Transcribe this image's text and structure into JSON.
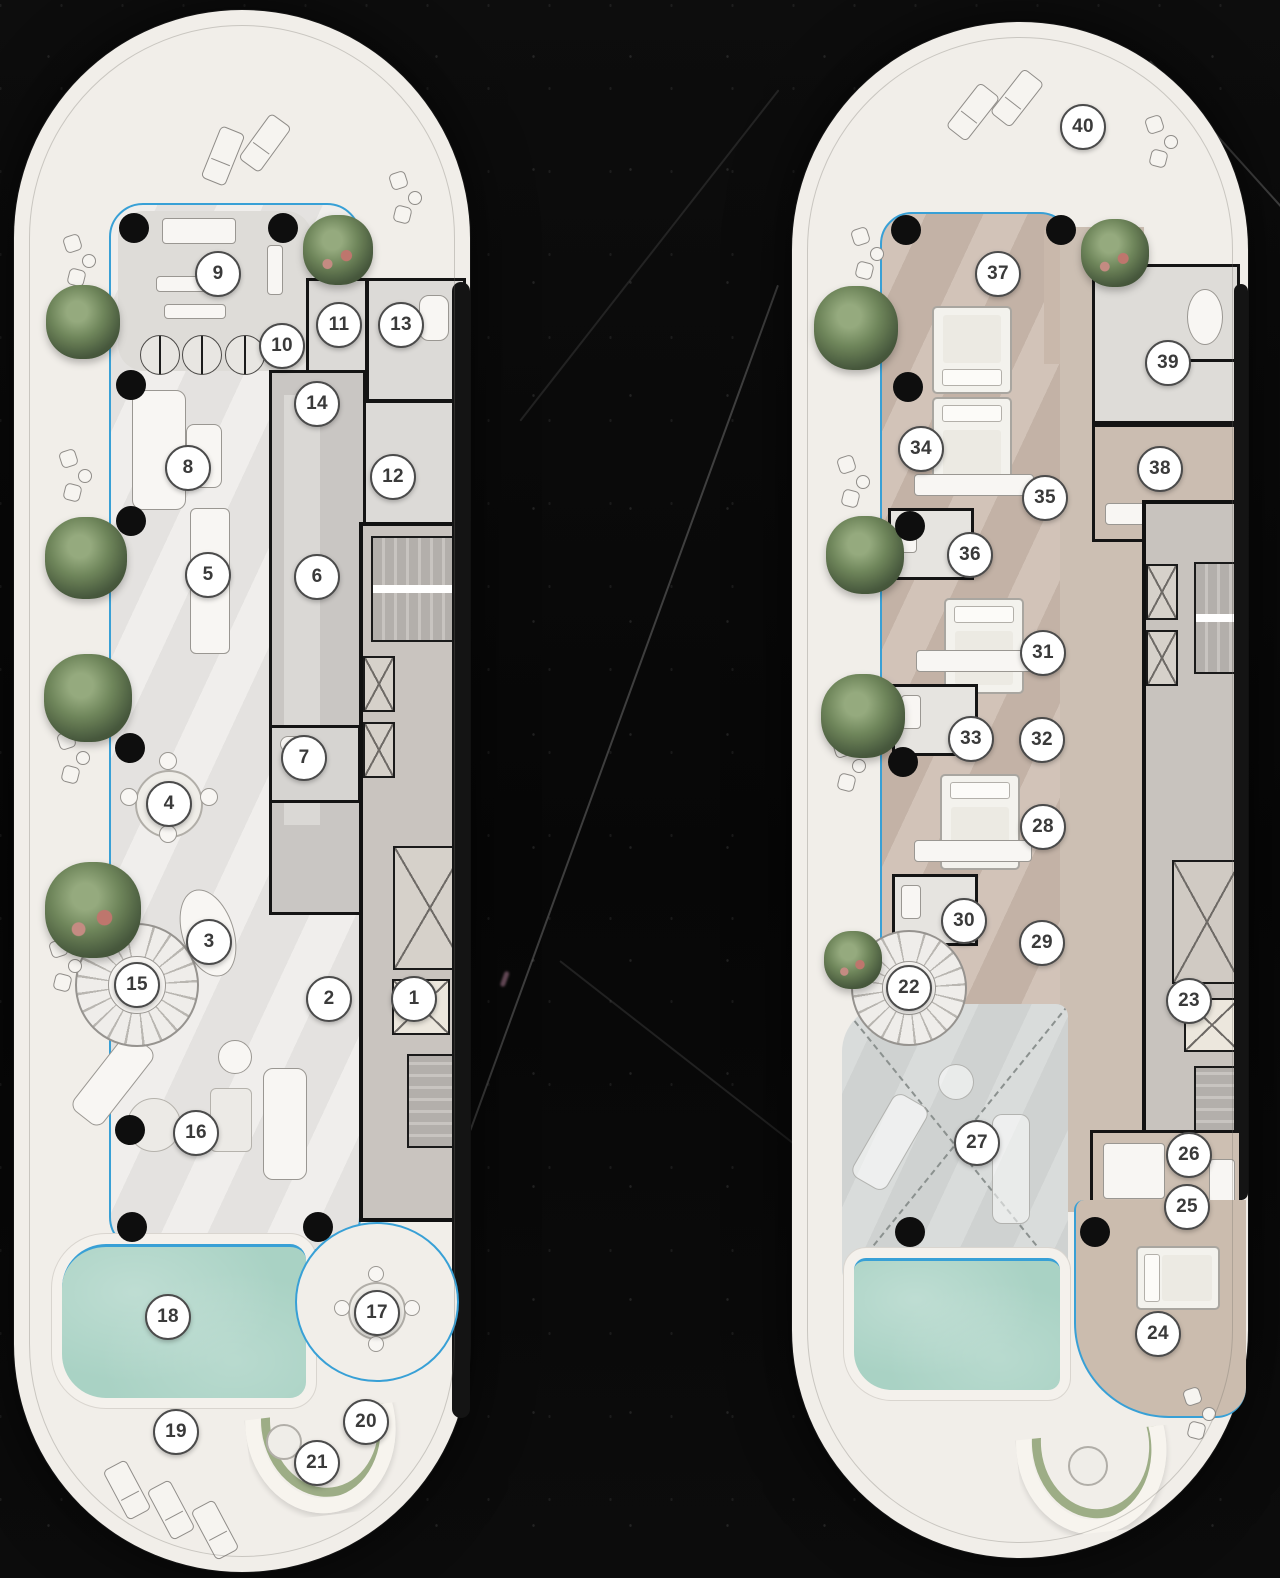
{
  "scene": {
    "description": "Two pill-shaped penthouse floor plans rendered on black marble",
    "palette": {
      "background": "#0a0a0a",
      "marble_vein": "#ffffff",
      "deck_white": "#f1eee9",
      "interior_light_gray": "#e9e7e4",
      "interior_tan": "#c9b8ab",
      "core_gray": "#c9c4bf",
      "stairs_gray": "#b3afab",
      "media_room_gray": "#d3d6d5",
      "pool_teal": "#a9d2c4",
      "facade_blue": "#38a0d6",
      "wall_black": "#141414",
      "plant_green": "#6c8656",
      "marker_bg": "#ffffff",
      "marker_border": "#4b4b4b",
      "marker_text": "#3a3a3a"
    }
  },
  "plans": [
    {
      "dom": "plan-a",
      "markers": [
        [
          1,
          400,
          989
        ],
        [
          2,
          315,
          989
        ],
        [
          3,
          195,
          932
        ],
        [
          4,
          155,
          794
        ],
        [
          5,
          194,
          565
        ],
        [
          6,
          303,
          567
        ],
        [
          7,
          290,
          748
        ],
        [
          8,
          174,
          458
        ],
        [
          9,
          204,
          264
        ],
        [
          10,
          268,
          336
        ],
        [
          11,
          325,
          315
        ],
        [
          12,
          379,
          467
        ],
        [
          13,
          387,
          315
        ],
        [
          14,
          303,
          394
        ],
        [
          15,
          123,
          975
        ],
        [
          16,
          182,
          1123
        ],
        [
          17,
          363,
          1303
        ],
        [
          18,
          154,
          1307
        ],
        [
          19,
          162,
          1422
        ],
        [
          20,
          352,
          1412
        ],
        [
          21,
          303,
          1453
        ]
      ],
      "columns": [
        [
          120,
          218
        ],
        [
          269,
          218
        ],
        [
          117,
          375
        ],
        [
          117,
          511
        ],
        [
          116,
          738
        ],
        [
          116,
          1120
        ],
        [
          118,
          1217
        ],
        [
          304,
          1217
        ]
      ],
      "plants": [
        [
          69,
          312,
          74,
          0
        ],
        [
          72,
          548,
          82,
          0
        ],
        [
          74,
          688,
          88,
          0
        ],
        [
          79,
          900,
          96,
          1
        ],
        [
          324,
          240,
          70,
          1
        ]
      ],
      "loungers": [
        [
          196,
          118,
          22
        ],
        [
          238,
          105,
          36
        ],
        [
          100,
          1452,
          -28
        ],
        [
          144,
          1472,
          -28
        ],
        [
          188,
          1492,
          -28
        ]
      ],
      "chair_pairs": [
        [
          48,
          225
        ],
        [
          44,
          440
        ],
        [
          42,
          722
        ],
        [
          34,
          930
        ],
        [
          374,
          162
        ]
      ]
    },
    {
      "dom": "plan-b",
      "markers": [
        [
          22,
          117,
          966
        ],
        [
          23,
          397,
          979
        ],
        [
          24,
          366,
          1312
        ],
        [
          25,
          395,
          1185
        ],
        [
          26,
          397,
          1133
        ],
        [
          27,
          185,
          1121
        ],
        [
          28,
          251,
          805
        ],
        [
          29,
          250,
          921
        ],
        [
          30,
          172,
          899
        ],
        [
          31,
          251,
          631
        ],
        [
          32,
          250,
          718
        ],
        [
          33,
          179,
          717
        ],
        [
          34,
          129,
          427
        ],
        [
          35,
          253,
          476
        ],
        [
          36,
          178,
          533
        ],
        [
          37,
          206,
          252
        ],
        [
          38,
          368,
          447
        ],
        [
          39,
          376,
          341
        ],
        [
          40,
          291,
          105
        ]
      ],
      "columns": [
        [
          114,
          208
        ],
        [
          269,
          208
        ],
        [
          116,
          365
        ],
        [
          118,
          504
        ],
        [
          111,
          740
        ],
        [
          118,
          1210
        ],
        [
          303,
          1210
        ]
      ],
      "plants": [
        [
          64,
          306,
          84,
          0
        ],
        [
          73,
          533,
          78,
          0
        ],
        [
          71,
          694,
          84,
          0
        ],
        [
          61,
          938,
          58,
          1
        ],
        [
          323,
          231,
          68,
          1
        ]
      ],
      "loungers": [
        [
          168,
          62,
          38
        ],
        [
          212,
          48,
          38
        ]
      ],
      "chair_pairs": [
        [
          58,
          206
        ],
        [
          44,
          434
        ],
        [
          40,
          718
        ],
        [
          352,
          94
        ],
        [
          390,
          1366
        ]
      ]
    }
  ]
}
